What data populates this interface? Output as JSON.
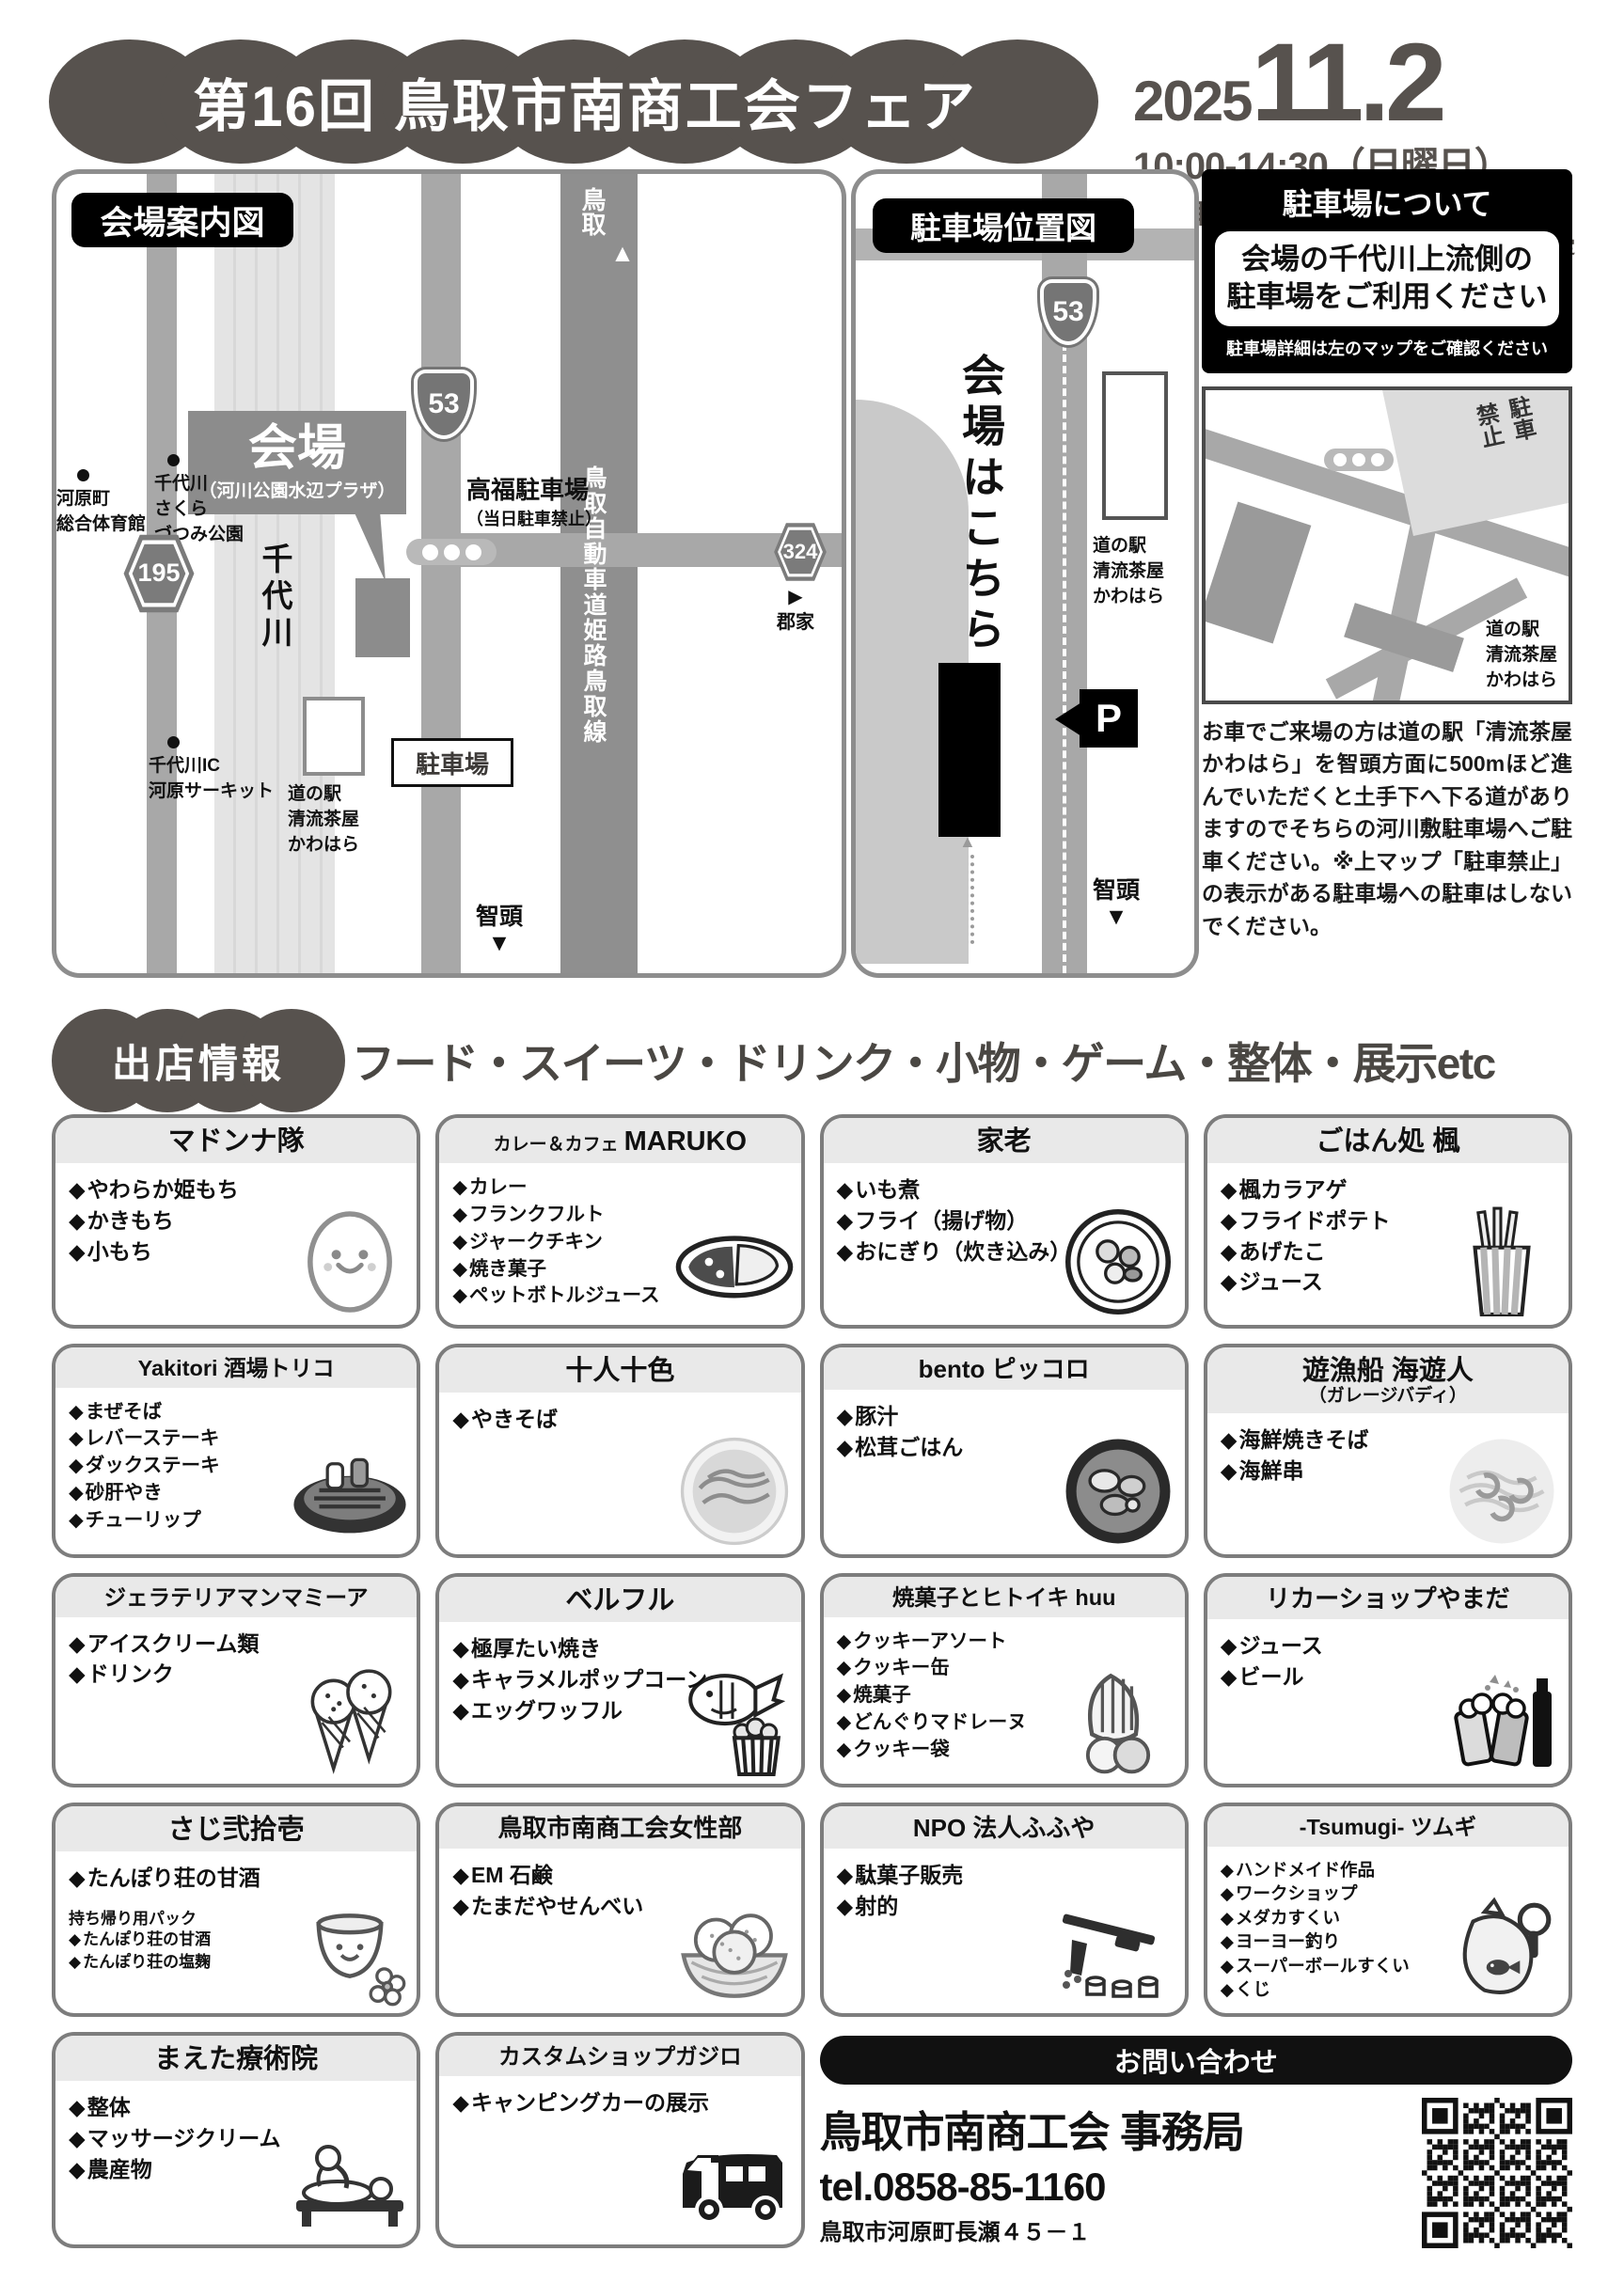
{
  "header": {
    "title": "第16回 鳥取市南商工会フェア",
    "year": "2025",
    "day": "11.2",
    "time": "10:00-14:30（日曜日）",
    "place_prefix": "in",
    "place": "鳥取市河原町河川公園水辺プラザ",
    "rain_note": "※少雨決行予定"
  },
  "venue_map": {
    "title": "会場案内図",
    "venue": "会場",
    "venue_sub": "（河川公園水辺プラザ）",
    "river": "千代川",
    "route_53": "53",
    "route_195": "195",
    "route_324": "324",
    "dir_tottori": "鳥取",
    "dir_chizu": "智頭",
    "dir_kooge": "郡家",
    "highway": "鳥取自動車道姫路鳥取線",
    "takafuku": "高福駐車場",
    "takafuku_note": "（当日駐車禁止）",
    "gym": "河原町\n総合体育館",
    "sakura_park": "千代川\nさくら\nづつみ公園",
    "michinoeki": "道の駅\n清流茶屋\nかわはら",
    "parking_label": "駐車場",
    "circuit": "千代川IC\n河原サーキット"
  },
  "parking_map": {
    "title": "駐車場位置図",
    "here": "会場はこちら",
    "route_53": "53",
    "michinoeki": "道の駅\n清流茶屋\nかわはら",
    "p": "P",
    "dir_chizu": "智頭"
  },
  "parking_info": {
    "title": "駐車場について",
    "highlight": "会場の千代川上流側の\n駐車場をご利用ください",
    "note": "駐車場詳細は左のマップをご確認ください",
    "no_parking": "駐車\n禁止",
    "michinoeki": "道の駅\n清流茶屋\nかわはら",
    "body": "お車でご来場の方は道の駅「清流茶屋かわはら」を智頭方面に500mほど進んでいただくと土手下へ下る道がありますのでそちらの河川敷駐車場へご駐車ください。※上マップ「駐車禁止」の表示がある駐車場への駐車はしないでください。"
  },
  "listing": {
    "badge": "出店情報",
    "headline": "フード・スイーツ・ドリンク・小物・ゲーム・整体・展示etc"
  },
  "cards": [
    {
      "name": "マドンナ隊",
      "items": [
        "やわらか姫もち",
        "かきもち",
        "小もち"
      ],
      "icon": "mochi-character"
    },
    {
      "prefix": "カレー＆カフェ",
      "name": "MARUKO",
      "items": [
        "カレー",
        "フランクフルト",
        "ジャークチキン",
        "焼き菓子",
        "ペットボトルジュース"
      ],
      "icon": "curry-plate"
    },
    {
      "name": "家老",
      "items": [
        "いも煮",
        "フライ（揚げ物）",
        "おにぎり（炊き込み）"
      ],
      "icon": "imoni-pot"
    },
    {
      "name": "ごはん処 楓",
      "items": [
        "楓カラアゲ",
        "フライドポテト",
        "あげたこ",
        "ジュース"
      ],
      "icon": "fries-cup"
    },
    {
      "name": "Yakitori 酒場トリコ",
      "items": [
        "まぜそば",
        "レバーステーキ",
        "ダックステーキ",
        "砂肝やき",
        "チューリップ"
      ],
      "icon": "yakitori-grill"
    },
    {
      "name": "十人十色",
      "items": [
        "やきそば"
      ],
      "icon": "yakisoba-plate"
    },
    {
      "name": "bento ピッコロ",
      "items": [
        "豚汁",
        "松茸ごはん"
      ],
      "icon": "rice-bowl"
    },
    {
      "name": "遊漁船 海遊人",
      "sub": "（ガレージバディ）",
      "items": [
        "海鮮焼きそば",
        "海鮮串"
      ],
      "icon": "seafood-noodles"
    },
    {
      "name": "ジェラテリアマンマミーア",
      "items": [
        "アイスクリーム類",
        "ドリンク"
      ],
      "icon": "ice-cream-cones"
    },
    {
      "name": "ベルフル",
      "items": [
        "極厚たい焼き",
        "キャラメルポップコーン",
        "エッグワッフル"
      ],
      "icon": "taiyaki-popcorn"
    },
    {
      "name": "焼菓子とヒトイキ huu",
      "items": [
        "クッキーアソート",
        "クッキー缶",
        "焼菓子",
        "どんぐりマドレーヌ",
        "クッキー袋"
      ],
      "icon": "madeleine"
    },
    {
      "name": "リカーショップやまだ",
      "items": [
        "ジュース",
        "ビール"
      ],
      "icon": "beer-mugs"
    },
    {
      "name": "さじ弐拾壱",
      "items": [
        "たんぽり荘の甘酒"
      ],
      "note_title": "持ち帰り用パック",
      "note_items": [
        "たんぽり荘の甘酒",
        "たんぽり荘の塩麹"
      ],
      "icon": "amazake-cup"
    },
    {
      "name": "鳥取市南商工会女性部",
      "items": [
        "EM 石鹸",
        "たまだやせんべい"
      ],
      "icon": "senbei-basket"
    },
    {
      "name": "NPO 法人ふふや",
      "items": [
        "駄菓子販売",
        "射的"
      ],
      "icon": "cork-rifle"
    },
    {
      "name": "-Tsumugi- ツムギ",
      "items": [
        "ハンドメイド作品",
        "ワークショップ",
        "メダカすくい",
        "ヨーヨー釣り",
        "スーパーボールすくい",
        "くじ"
      ],
      "icon": "goldfish-bag"
    },
    {
      "name": "まえた療術院",
      "items": [
        "整体",
        "マッサージクリーム",
        "農産物"
      ],
      "icon": "massage-scene"
    },
    {
      "name": "カスタムショップガジロ",
      "items": [
        "キャンピングカーの展示"
      ],
      "icon": "camper-van"
    }
  ],
  "contact": {
    "title": "お問い合わせ",
    "org": "鳥取市南商工会 事務局",
    "tel": "tel.0858-85-1160",
    "address": "鳥取市河原町長瀬４５－１"
  }
}
